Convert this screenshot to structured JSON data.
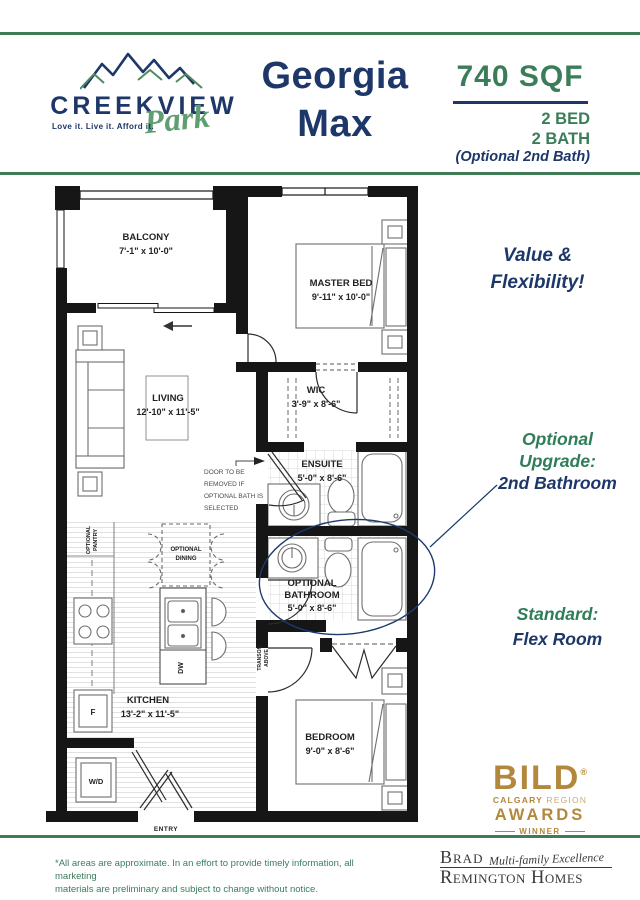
{
  "colors": {
    "green_line": "#3f7b55",
    "green_text": "#3a7d58",
    "navy": "#1d3768",
    "gold": "#b3883c",
    "gold_light": "#c8ab76",
    "logo_green": "#5f9e71",
    "brh_gray": "#3a3a3a"
  },
  "header": {
    "logo": {
      "name": "CREEKVIEW",
      "script": "Park",
      "tagline": "Love it. Live it. Afford it."
    },
    "plan_name_line1": "Georgia",
    "plan_name_line2": "Max",
    "sqft": "740 SQF",
    "bed": "2 BED",
    "bath": "2 BATH",
    "optional": "(Optional 2nd Bath)"
  },
  "plan": {
    "rooms": {
      "balcony": {
        "name": "BALCONY",
        "dims": "7'-1\" x 10'-0\""
      },
      "master": {
        "name": "MASTER BED",
        "dims": "9'-11\" x 10'-0\""
      },
      "living": {
        "name": "LIVING",
        "dims": "12'-10\" x 11'-5\""
      },
      "wic": {
        "name": "WIC",
        "dims": "3'-9\" x 8'-6\""
      },
      "ensuite": {
        "name": "ENSUITE",
        "dims": "5'-0\" x 8'-6\""
      },
      "optbath": {
        "name1": "OPTIONAL",
        "name2": "BATHROOM",
        "dims": "5'-0\" x 8'-6\""
      },
      "kitchen": {
        "name": "KITCHEN",
        "dims": "13'-2\" x 11'-5\""
      },
      "bedroom": {
        "name": "BEDROOM",
        "dims": "9'-0\" x 8'-6\""
      }
    },
    "labels": {
      "wd": "W/D",
      "fridge": "F",
      "dw": "DW",
      "entry": "ENTRY",
      "transom1": "TRANSOM",
      "transom2": "ABOVE",
      "pantry1": "OPTIONAL",
      "pantry2": "PANTRY",
      "dining1": "OPTIONAL",
      "dining2": "DINING"
    },
    "note": {
      "l1": "DOOR TO BE",
      "l2": "REMOVED IF",
      "l3": "OPTIONAL BATH IS",
      "l4": "SELECTED"
    }
  },
  "annotations": {
    "value_line1": "Value &",
    "value_line2": "Flexibility!",
    "upgrade_line1": "Optional",
    "upgrade_line2": "Upgrade:",
    "upgrade_line3": "2nd Bathroom",
    "standard_line1": "Standard:",
    "standard_line2": "Flex Room"
  },
  "award": {
    "bild": "BILD",
    "reg": "®",
    "calgary": "CALGARY",
    "region": "REGION",
    "awards": "AWARDS",
    "winner": "WINNER"
  },
  "footer": {
    "disclaimer_line1": "*All areas are approximate. In an effort to provide timely information, all marketing",
    "disclaimer_line2": "materials are preliminary and subject to change without notice.",
    "brh_name1": "Brad",
    "brh_script": "Multi-family Excellence",
    "brh_name2": "Remington Homes"
  }
}
